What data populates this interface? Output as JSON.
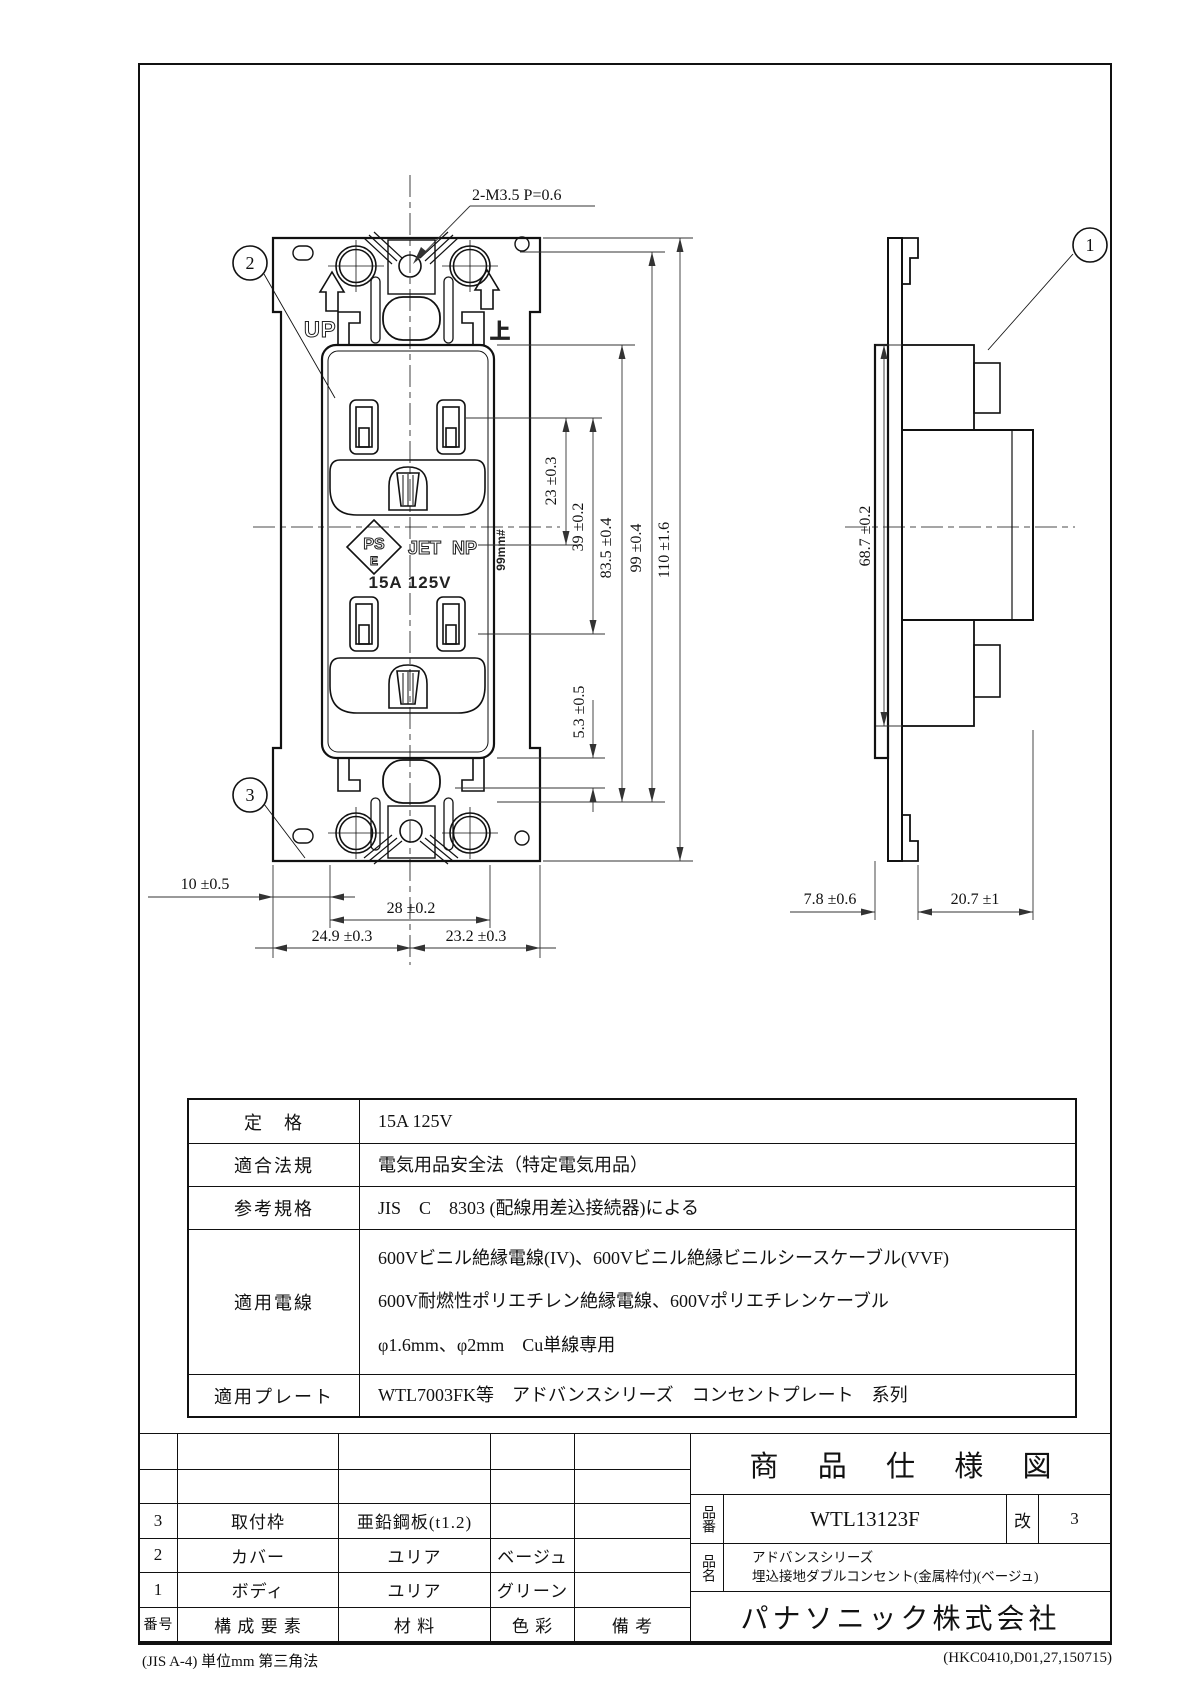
{
  "drawing": {
    "callout_1": "1",
    "callout_2": "2",
    "callout_3": "3",
    "screw_note": "2-M3.5 P=0.6",
    "face": {
      "up": "UP",
      "ue": "上",
      "ps": "PS",
      "e": "E",
      "jet": "JET",
      "np": "NP",
      "rating": "15A 125V",
      "side_marking": "99mm#"
    },
    "dims": {
      "d23": "23 ±0.3",
      "d39": "39 ±0.2",
      "d5_3": "5.3 ±0.5",
      "d83_5": "83.5 ±0.4",
      "d99": "99 ±0.4",
      "d110": "110 ±1.6",
      "d10": "10 ±0.5",
      "d28": "28 ±0.2",
      "d24_9": "24.9 ±0.3",
      "d23_2": "23.2 ±0.3",
      "d68_7": "68.7 ±0.2",
      "d7_8": "7.8 ±0.6",
      "d20_7": "20.7 ±1"
    }
  },
  "spec_table": {
    "rows": [
      {
        "label": "定　格",
        "value": "15A  125V"
      },
      {
        "label": "適合法規",
        "value": "電気用品安全法（特定電気用品）"
      },
      {
        "label": "参考規格",
        "value": "JIS　C　8303 (配線用差込接続器)による"
      },
      {
        "label": "適用電線",
        "line1": "600Vビニル絶縁電線(IV)、600Vビニル絶縁ビニルシースケーブル(VVF)",
        "line2": "600V耐燃性ポリエチレン絶縁電線、600Vポリエチレンケーブル",
        "line3": "φ1.6mm、φ2mm　Cu単線専用"
      },
      {
        "label": "適用プレート",
        "value": "WTL7003FK等　アドバンスシリーズ　コンセントプレート　系列"
      }
    ]
  },
  "parts_table": {
    "headers": {
      "no": "番号",
      "component": "構 成 要 素",
      "material": "材  料",
      "color": "色  彩",
      "note": "備  考"
    },
    "rows": [
      {
        "no": "3",
        "component": "取付枠",
        "material": "亜鉛鋼板(t1.2)",
        "color": "",
        "note": ""
      },
      {
        "no": "2",
        "component": "カバー",
        "material": "ユリア",
        "color": "ベージュ",
        "note": ""
      },
      {
        "no": "1",
        "component": "ボディ",
        "material": "ユリア",
        "color": "グリーン",
        "note": ""
      }
    ]
  },
  "title_block": {
    "doc_title": "商 品 仕 様 図",
    "part_no_label": "品番",
    "part_no": "WTL13123F",
    "rev_label": "改",
    "rev_value": "3",
    "name_label": "品名",
    "name_line1": "アドバンスシリーズ",
    "name_line2": "埋込接地ダブルコンセント(金属枠付)(ベージュ)",
    "company": "パナソニック株式会社"
  },
  "footer": {
    "left": "(JIS A-4)  単位mm  第三角法",
    "right": "(HKC0410,D01,27,150715)"
  }
}
